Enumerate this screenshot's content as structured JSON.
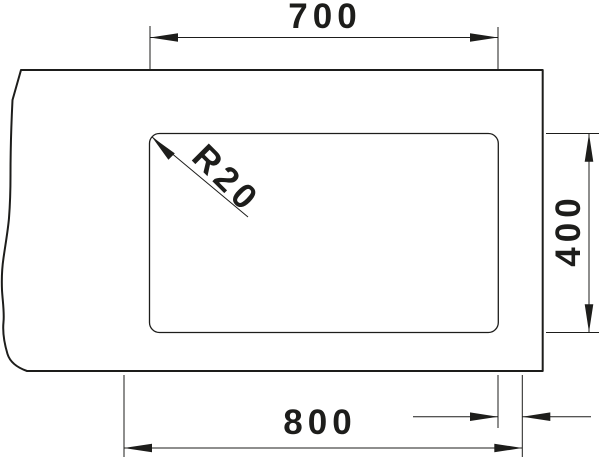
{
  "diagram": {
    "type": "technical-dimension-drawing",
    "subject": "sink-undermount-cutout-plan",
    "background_color": "#ffffff",
    "line_color": "#1d1d1b",
    "labels": {
      "top_width": "700",
      "right_height": "400",
      "bottom_width": "800",
      "right_edge_offset": "50",
      "corner_radius": "R20"
    }
  }
}
